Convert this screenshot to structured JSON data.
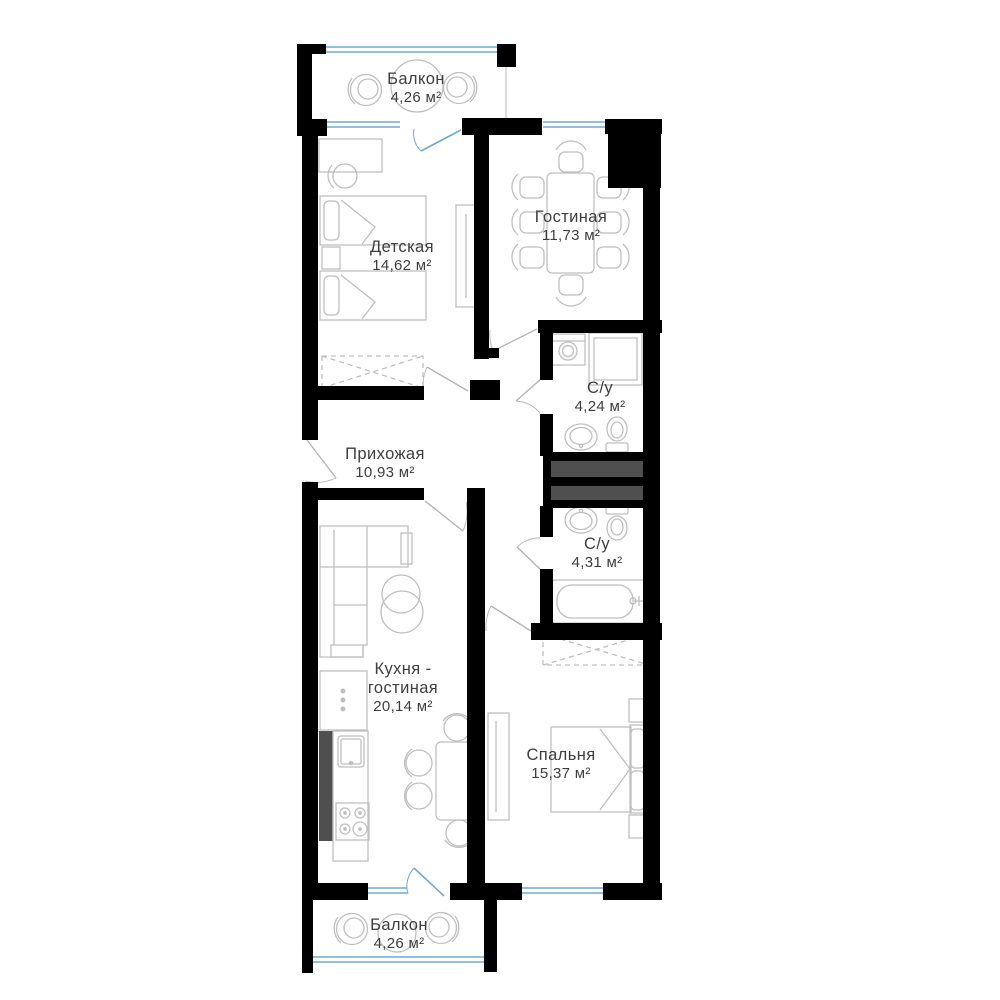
{
  "plan": {
    "rooms": [
      {
        "id": "balcony-top",
        "name": "Балкон",
        "area": "4,26 м²"
      },
      {
        "id": "children",
        "name": "Детская",
        "area": "14,62 м²"
      },
      {
        "id": "living",
        "name": "Гостиная",
        "area": "11,73 м²"
      },
      {
        "id": "bath-1",
        "name": "С/у",
        "area": "4,24 м²"
      },
      {
        "id": "hallway",
        "name": "Прихожая",
        "area": "10,93 м²"
      },
      {
        "id": "bath-2",
        "name": "С/у",
        "area": "4,31 м²"
      },
      {
        "id": "kitchen-living",
        "name_line1": "Кухня -",
        "name_line2": "гостиная",
        "area": "20,14 м²"
      },
      {
        "id": "bedroom",
        "name": "Спальня",
        "area": "15,37 м²"
      },
      {
        "id": "balcony-bottom",
        "name": "Балкон",
        "area": "4,26 м²"
      }
    ],
    "colors": {
      "wall": "#000000",
      "shaft": "#4f4f4f",
      "window_glass": "#6fa8d6",
      "furniture_outline": "#bfbfbf",
      "door_swing": "#b5b5b5",
      "label_text": "#3e3e3e",
      "background": "#ffffff"
    }
  }
}
